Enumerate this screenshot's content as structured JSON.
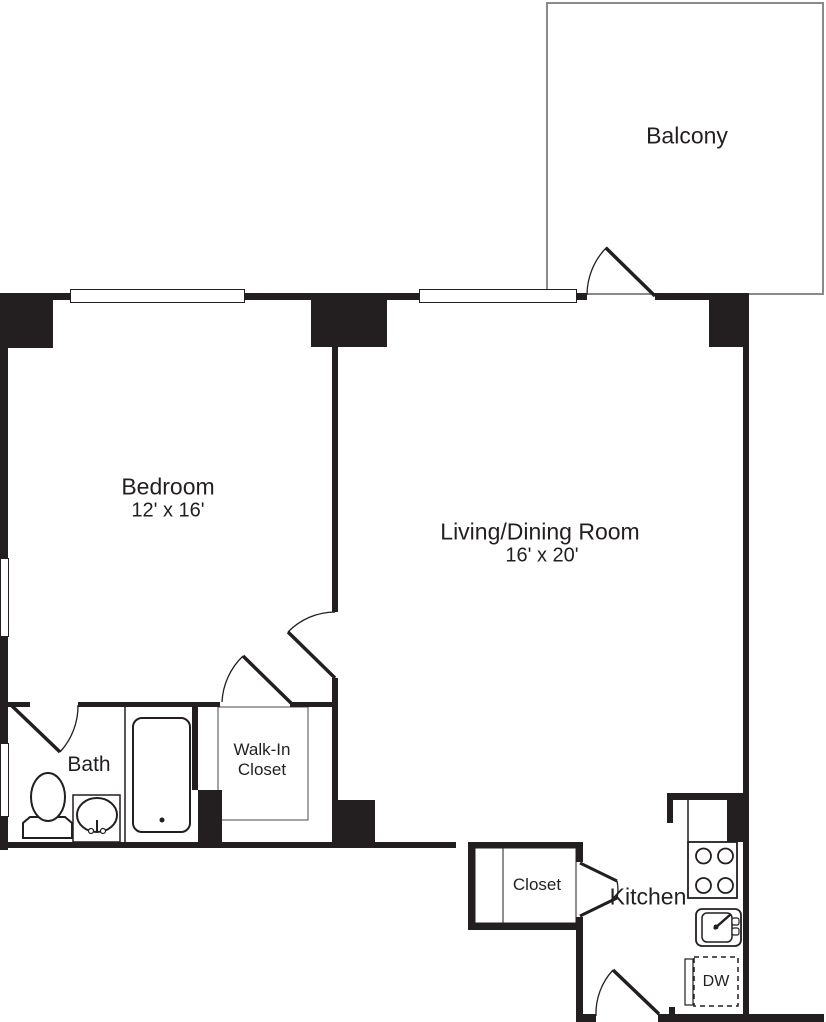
{
  "floorplan": {
    "balcony": {
      "name": "Balcony"
    },
    "bedroom": {
      "name": "Bedroom",
      "dims": "12' x 16'"
    },
    "living_dining": {
      "name": "Living/Dining Room",
      "dims": "16' x 20'"
    },
    "bath": {
      "name": "Bath"
    },
    "walk_in_closet": {
      "name": "Walk-In Closet",
      "lines": [
        "Walk-In",
        "Closet"
      ]
    },
    "closet": {
      "name": "Closet"
    },
    "kitchen": {
      "name": "Kitchen"
    },
    "dishwasher": {
      "abbr": "DW"
    },
    "colors": {
      "wall": "#231f20",
      "balcony_outline": "#8a8a8a",
      "background": "#ffffff"
    }
  }
}
